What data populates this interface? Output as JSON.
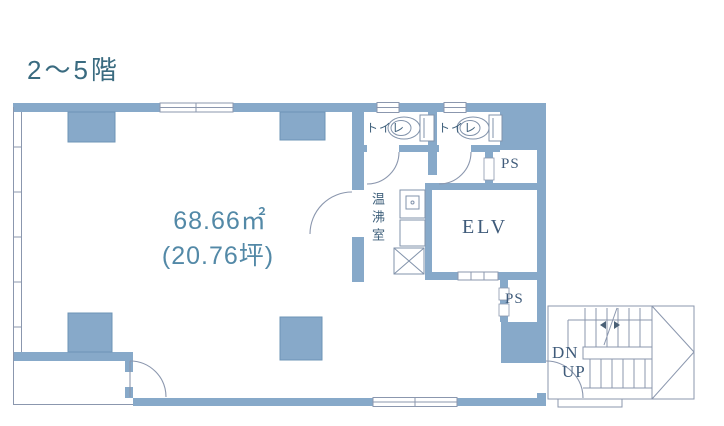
{
  "title": "2〜5階",
  "colors": {
    "wall_fill": "#87a9c9",
    "wall_edge": "#6e94b6",
    "thin_line": "#8b97ae",
    "title_text": "#3a6b80",
    "area_text": "#5389a7",
    "room_text_jp": "#40617c",
    "room_text_serif": "#3f5b7a",
    "background": "#ffffff"
  },
  "floor_plan": {
    "main_room": {
      "area_m2": "68.66㎡",
      "area_tsubo": "(20.76坪)"
    },
    "rooms": [
      {
        "id": "toilet-1",
        "label": "トイレ"
      },
      {
        "id": "toilet-2",
        "label": "トイレ"
      },
      {
        "id": "ps-upper",
        "label": "PS"
      },
      {
        "id": "hot-water-room",
        "label": "温沸室"
      },
      {
        "id": "elevator",
        "label": "ELV"
      },
      {
        "id": "ps-lower",
        "label": "PS"
      }
    ],
    "stairs": {
      "down_label": "DN",
      "up_label": "UP"
    }
  }
}
